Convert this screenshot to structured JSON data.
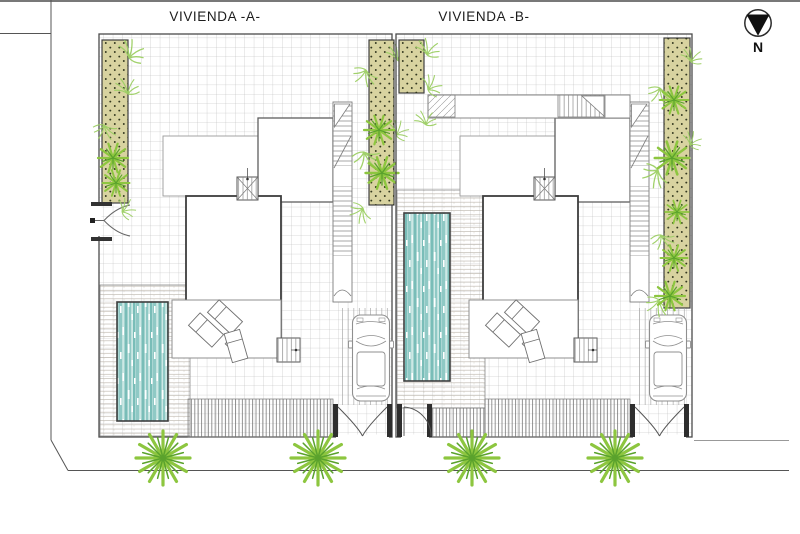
{
  "drawing": {
    "type": "site-plan",
    "north_label": "N"
  },
  "plots": [
    {
      "label": "VIVIENDA -A-",
      "elements": {
        "house": true,
        "pool": true,
        "pool_deck": true,
        "sun_loungers": 3,
        "car": 1,
        "driveway_gate": true,
        "pedestrian_gate_side": "west wall",
        "planting_strips": 2,
        "street_trees": 2
      }
    },
    {
      "label": "VIVIENDA -B-",
      "elements": {
        "house": true,
        "pool": true,
        "pool_deck": true,
        "sun_loungers": 3,
        "car": 1,
        "driveway_gate": true,
        "pedestrian_gate_side": "street side",
        "planting_strips": 2,
        "street_trees": 2
      }
    }
  ],
  "colors": {
    "planting-bed": "#d8d3a0",
    "planting-dot": "#33381f",
    "foliage-light": "#8dc63f",
    "foliage-dark": "#5aa22c",
    "fern": "#9ccf63",
    "pool-teal": "#8fc9c5",
    "pool-teal-dark": "#79bdb8",
    "pool-teal-light": "#cde8e5",
    "line-dark": "#3a3a3a",
    "line-mid": "#777777",
    "grid-line": "#b7b7b7"
  }
}
